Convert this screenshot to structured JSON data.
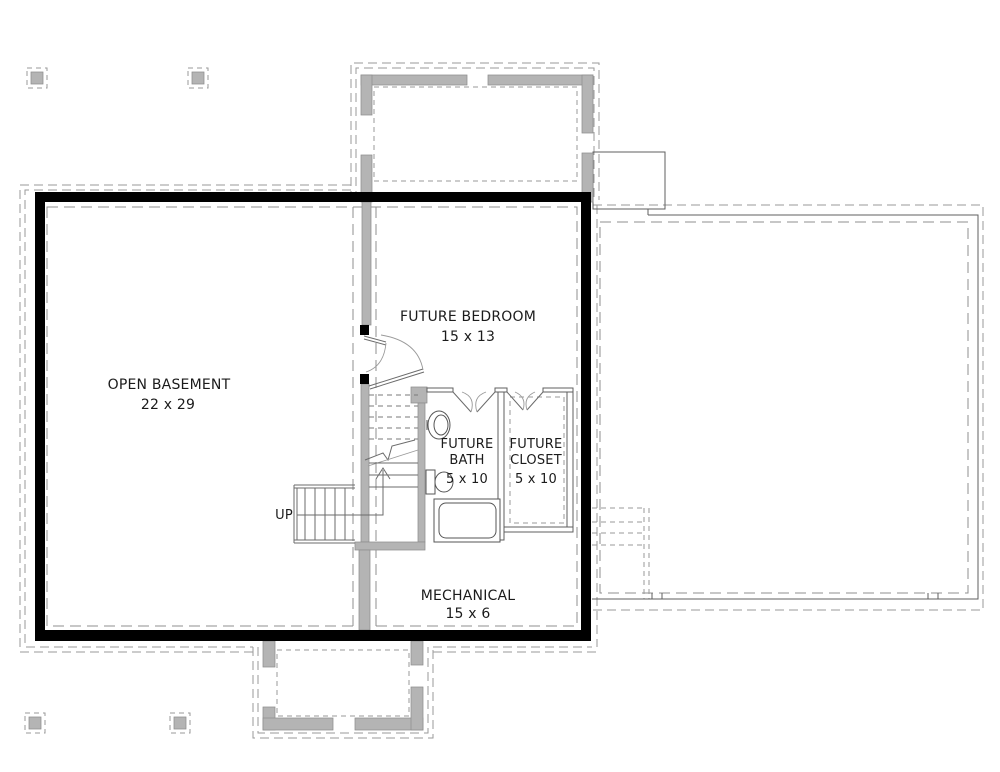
{
  "colors": {
    "background": "#ffffff",
    "wall": "#000000",
    "concrete_fill": "#b4b4b4",
    "concrete_edge": "#8e8e8e",
    "dashed_line": "#9a9a9a",
    "thin_line": "#5f5f5f",
    "text": "#1b1b1b"
  },
  "plan": {
    "rooms": [
      {
        "id": "open-basement",
        "label": "OPEN BASEMENT",
        "dimensions": "22 x 29"
      },
      {
        "id": "future-bedroom",
        "label": "FUTURE BEDROOM",
        "dimensions": "15 x 13"
      },
      {
        "id": "future-bath",
        "label_line1": "FUTURE",
        "label_line2": "BATH",
        "dimensions": "5 x 10"
      },
      {
        "id": "future-closet",
        "label_line1": "FUTURE",
        "label_line2": "CLOSET",
        "dimensions": "5 x 10"
      },
      {
        "id": "mechanical",
        "label": "MECHANICAL",
        "dimensions": "15 x 6"
      }
    ],
    "stair": {
      "direction_label": "UP"
    },
    "fixtures": [
      "toilet-fixture",
      "sink-fixture",
      "bathtub-fixture"
    ]
  }
}
